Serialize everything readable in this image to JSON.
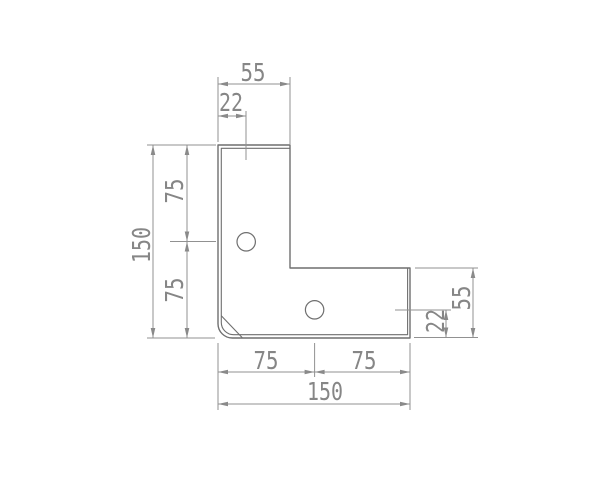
{
  "drawing": {
    "type": "technical-dimension-drawing",
    "colors": {
      "background": "#ffffff",
      "part_outline": "#6f6f6f",
      "dimension_lines": "#919191",
      "dimension_text": "#868686"
    },
    "part": {
      "shape": "L-bracket",
      "hole_count": 2
    },
    "dims": {
      "top_leg_width": "55",
      "top_hole_offset": "22",
      "left_overall": "150",
      "left_upper_half": "75",
      "left_lower_half": "75",
      "bottom_left_half": "75",
      "bottom_right_half": "75",
      "bottom_overall": "150",
      "right_leg_height": "55",
      "right_hole_offset": "22"
    }
  }
}
